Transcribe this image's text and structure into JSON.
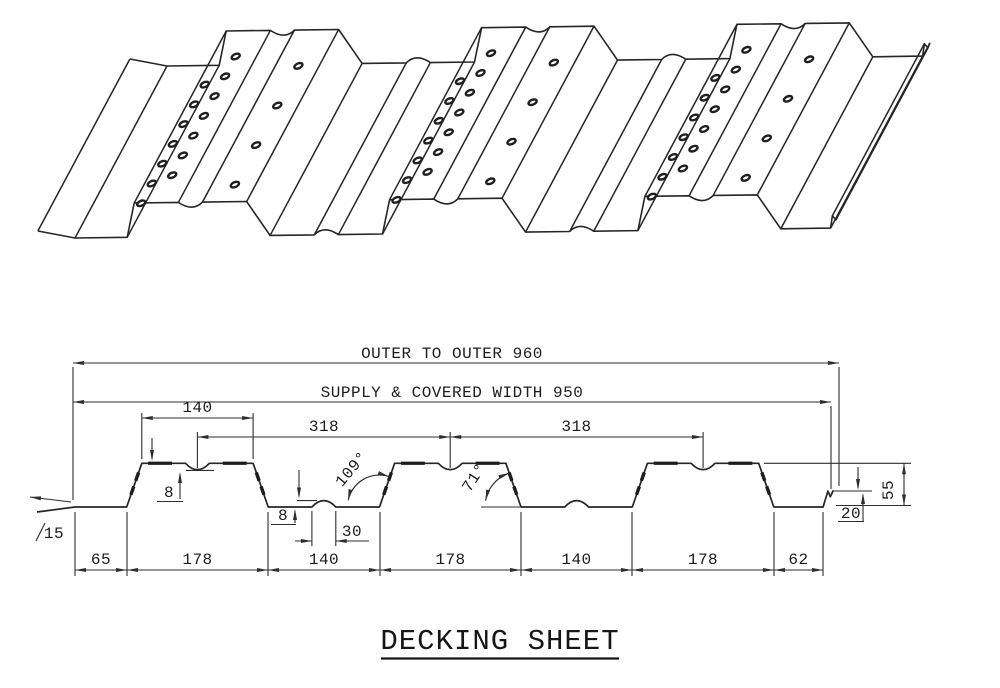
{
  "title": "DECKING SHEET",
  "dimensions": {
    "outer": "OUTER TO OUTER 960",
    "supply": "SUPPLY & COVERED WIDTH 950",
    "rib_top": "140",
    "pitch_a": "318",
    "pitch_b": "318",
    "dimple_depth": "8",
    "bump_height": "8",
    "bump_width": "30",
    "angle_left": "109°",
    "angle_right": "71°",
    "lip_left": "15",
    "lip_right": "20",
    "depth": "55",
    "chain": [
      "65",
      "178",
      "140",
      "178",
      "140",
      "178",
      "62"
    ]
  },
  "colors": {
    "line": "#262626",
    "dim_line": "#2e2e2e",
    "background": "#ffffff"
  }
}
